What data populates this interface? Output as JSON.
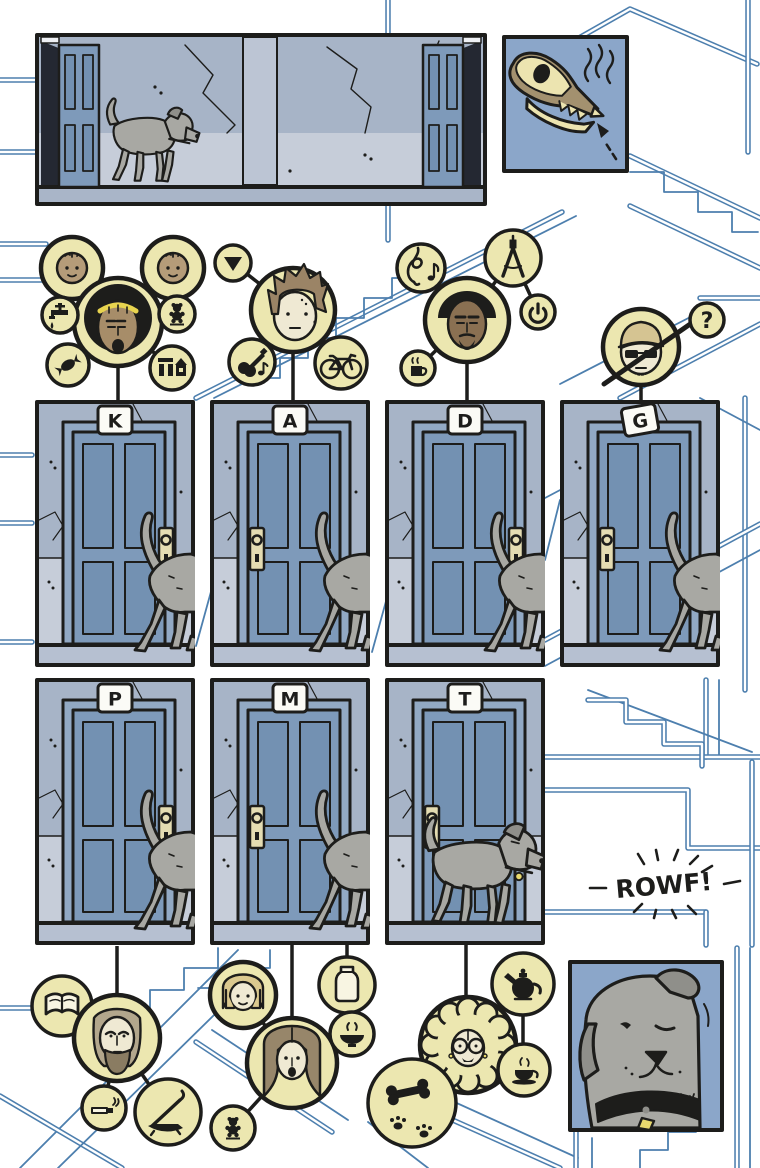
{
  "colors": {
    "blueprint": "#4d7fae",
    "ink": "#1d1d1b",
    "cream_circle": "#ece7b0",
    "panel_blue": "#8ba6c9",
    "wall_upper": "#a7b4c7",
    "wall_lower": "#c6cdd9",
    "door_blue": "#7e9aba",
    "dog_gray": "#a8a8a3",
    "collar_tag_yellow": "#e8d96e"
  },
  "rowf": {
    "text": "ROWF!"
  },
  "doors": [
    {
      "label": "K",
      "lock": "right",
      "dog": "rear",
      "tilt": 0
    },
    {
      "label": "A",
      "lock": "left",
      "dog": "rear",
      "tilt": 0
    },
    {
      "label": "D",
      "lock": "right",
      "dog": "rear",
      "tilt": 0
    },
    {
      "label": "G",
      "lock": "left",
      "dog": "rear",
      "tilt": -10
    },
    {
      "label": "P",
      "lock": "right",
      "dog": "rear",
      "tilt": 0
    },
    {
      "label": "M",
      "lock": "left",
      "dog": "rear",
      "tilt": 0
    },
    {
      "label": "T",
      "lock": "left",
      "dog": "full",
      "tilt": 0
    }
  ],
  "clusters": {
    "k": {
      "person": "woman-with-yellow-headband",
      "satellites": [
        "toddler-face",
        "toddler-face",
        "faucet",
        "teddy-bear",
        "candy",
        "building-blocks"
      ]
    },
    "a": {
      "person": "young-man-shaggy-hair",
      "satellites": [
        "down-triangle",
        "electric-guitar-with-note",
        "bicycle"
      ]
    },
    "d": {
      "person": "man-with-afro-and-goatee",
      "satellites": [
        "treble-clef-with-note",
        "drafting-compass",
        "power-button",
        "coffee-mug"
      ]
    },
    "g": {
      "person": "man-cap-sunglasses-crossed-out",
      "satellites": [
        "question-mark"
      ],
      "question_glyph": "?"
    },
    "p": {
      "person": "older-man-long-hair-beard",
      "satellites": [
        "open-book",
        "cigarette",
        "smoking-pipe"
      ]
    },
    "m": {
      "person": "woman-long-brown-hair",
      "satellites": [
        "girl-face",
        "teddy-bear",
        "bottle",
        "steaming-bowl"
      ]
    },
    "t": {
      "person": "elderly-woman-round-glasses",
      "satellites": [
        "teapot",
        "teacup",
        "bone-and-paw-prints"
      ]
    }
  },
  "panels": {
    "hallway": "dog-walking-through-apartment-hallway",
    "skull": "dog-skull-sniffing-xray",
    "dog_closeup": "dog-face-closeup"
  }
}
